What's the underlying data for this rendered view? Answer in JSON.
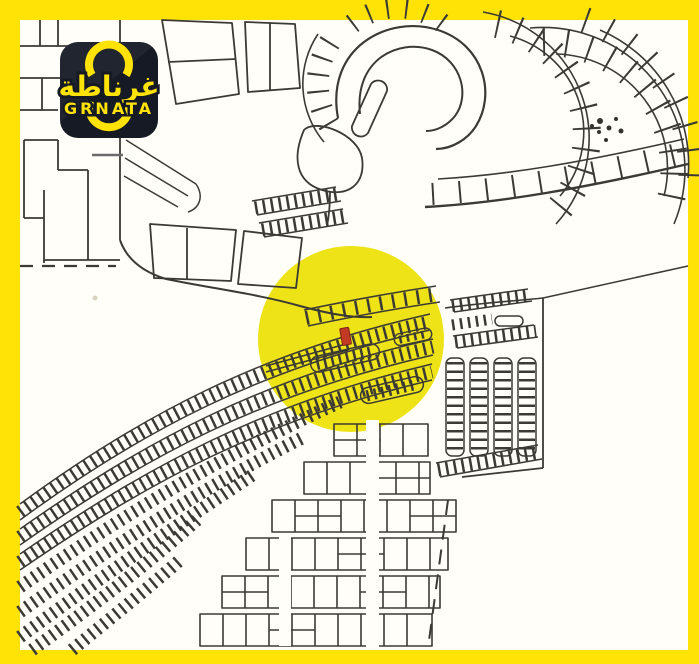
{
  "logo": {
    "arabic_name": "غرناطة",
    "latin_name": "GRNATA",
    "background_color": "#151A24",
    "accent_color": "#FFE206"
  },
  "frame": {
    "color": "#FFE206"
  },
  "map": {
    "paper_color": "#FFFEF8",
    "line_color": "#3B3A34",
    "highlight_circle": {
      "color": "#EEE316",
      "cx": 351,
      "cy": 339,
      "r": 93
    },
    "marker": {
      "color": "#C23A24"
    }
  }
}
